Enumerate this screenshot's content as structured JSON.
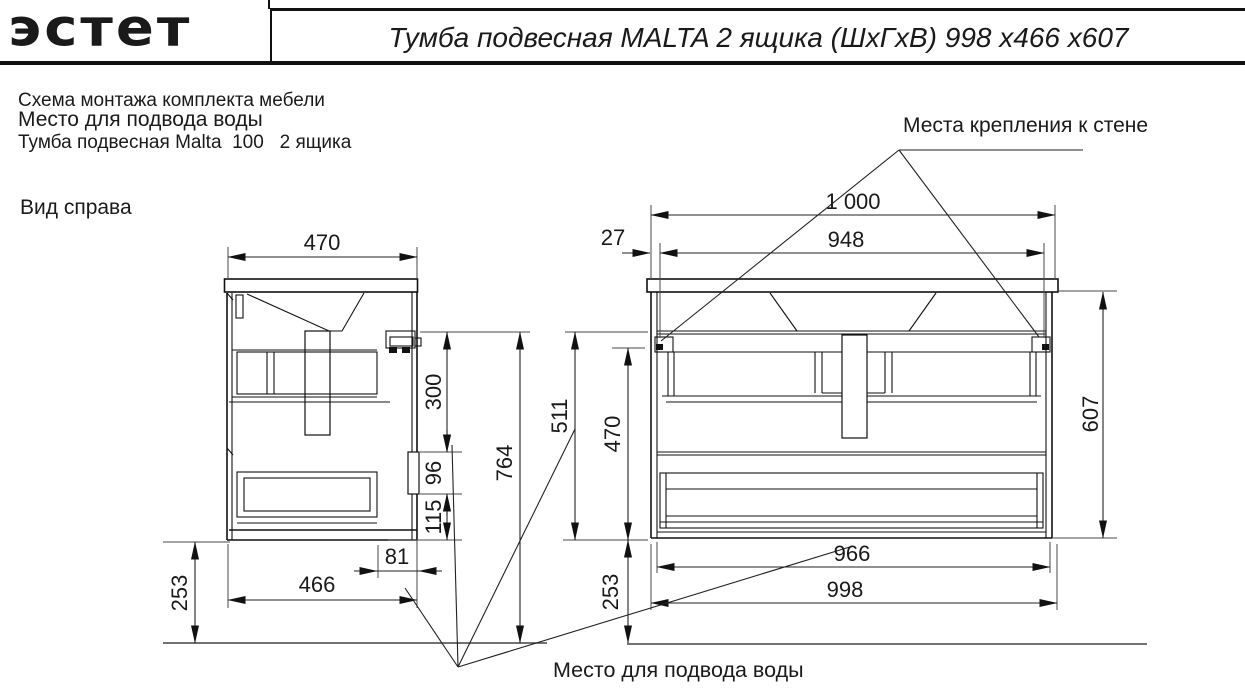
{
  "header": {
    "logo": "эстет",
    "title": "Тумба подвесная MALTA 2 ящика (ШхГхВ) 998 х466 х607"
  },
  "notes": {
    "line1": "Схема монтажа комплекта мебели",
    "line2": "Место для подвода воды",
    "line3": "Тумба подвесная Malta  100   2 ящика"
  },
  "labels": {
    "side_view": "Вид справа",
    "wall_mount": "Места крепления к стене",
    "water_supply": "Место для подвода воды"
  },
  "dims": {
    "side_top_width": "470",
    "side_bracket_to_cutout": "300",
    "side_cutout_height": "96",
    "side_cutout_to_bottom": "115",
    "side_bracket_to_floor": "764",
    "side_bottom_width": "466",
    "side_back_offset": "81",
    "side_bottom_to_floor": "253",
    "front_overall_width": "1 000",
    "front_mount_span": "948",
    "front_mount_offset": "27",
    "front_height": "607",
    "front_rail_to_bottom": "511",
    "front_body_height": "470",
    "front_bottom_to_floor": "253",
    "front_inner_width": "966",
    "front_outer_width": "998"
  },
  "colors": {
    "ink": "#1a1a1a",
    "paper": "#ffffff"
  }
}
